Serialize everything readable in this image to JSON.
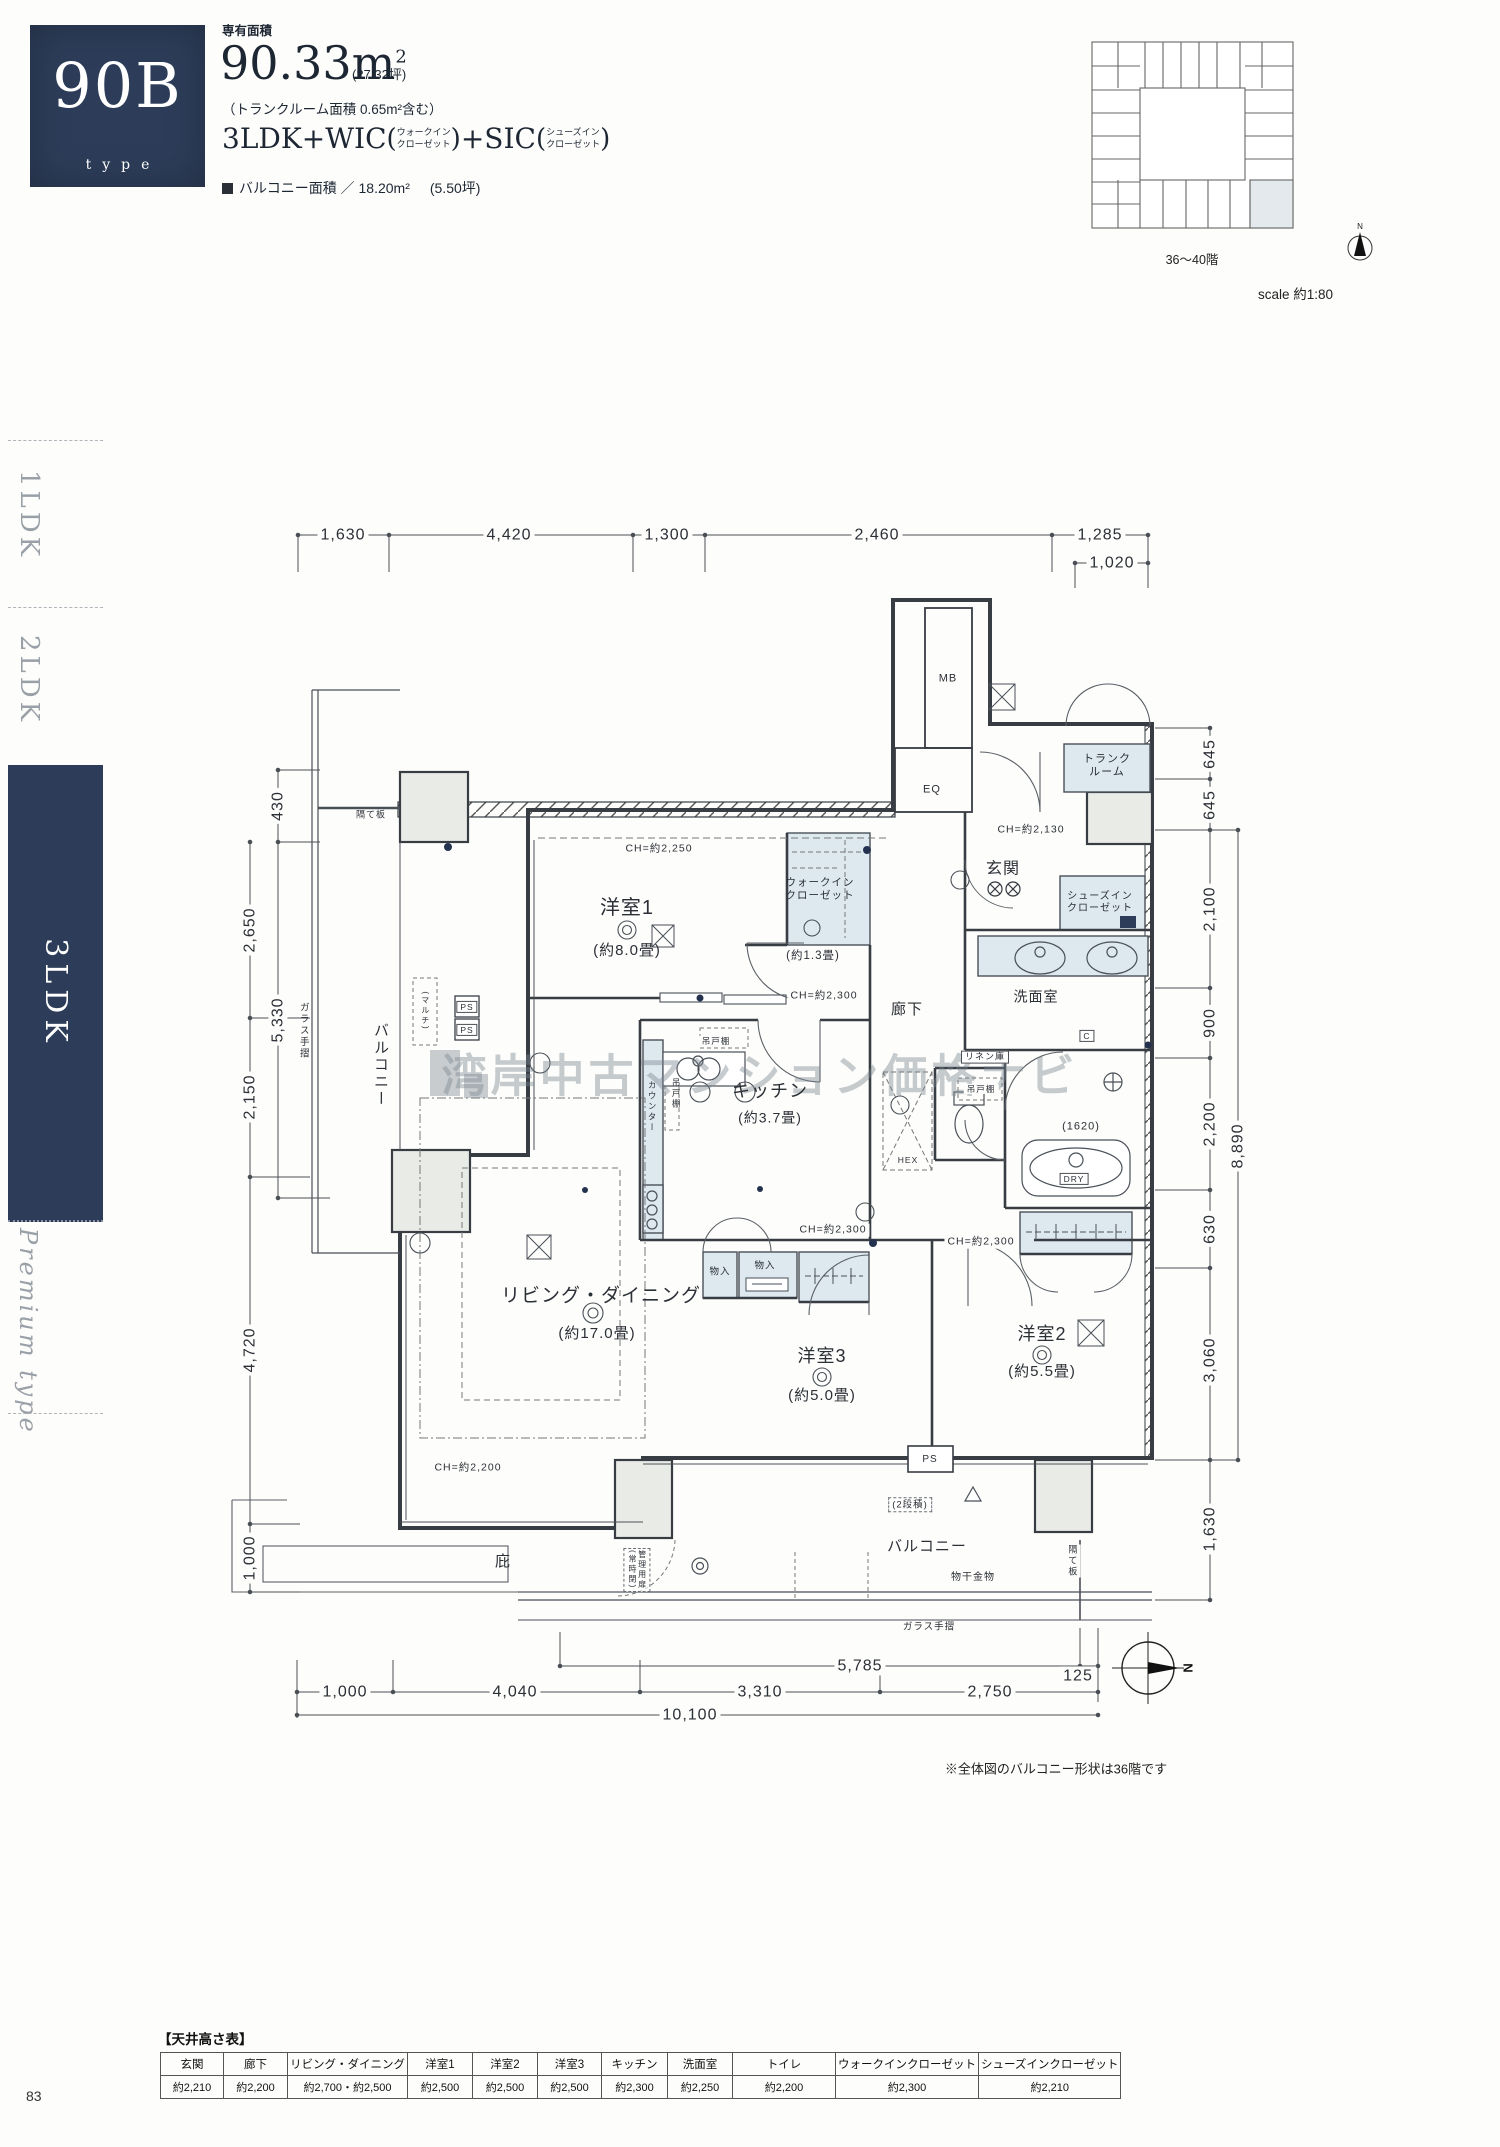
{
  "page": {
    "number": "83"
  },
  "sidebar": {
    "items": [
      {
        "label": "1LDK",
        "active": false
      },
      {
        "label": "2LDK",
        "active": false
      },
      {
        "label": "3LDK",
        "active": true
      },
      {
        "label": "Premium type",
        "active": false
      }
    ]
  },
  "header": {
    "type_code": "90B",
    "type_word": "type",
    "area_label": "専有面積",
    "area_value": "90.33m",
    "area_sup": "2",
    "area_tsubo": "(27.32坪)",
    "trunk_note": "（トランクルーム面積 0.65m²含む）",
    "layout_a": "3LDK+WIC",
    "wic_note_1": "ウォークイン",
    "wic_note_2": "クローゼット",
    "layout_b": "+SIC",
    "sic_note_1": "シューズイン",
    "sic_note_2": "クローゼット",
    "paren_open": "(",
    "paren_close": ")",
    "balcony_label": "バルコニー面積 ／ 18.20m²",
    "balcony_tsubo": "(5.50坪)"
  },
  "keyplan": {
    "floors": "36〜40階",
    "scale": "scale 約1:80",
    "north": "N"
  },
  "watermark": "湾岸中古マンション価格ナビ",
  "plan": {
    "note": "※全体図のバルコニー形状は36階です",
    "north": "N",
    "labels": [
      {
        "t": "洋室1",
        "x": 627,
        "y": 908,
        "s": 20
      },
      {
        "t": "(約8.0畳)",
        "x": 627,
        "y": 951,
        "s": 15
      },
      {
        "t": "リビング・ダイニング",
        "x": 601,
        "y": 1297,
        "s": 19
      },
      {
        "t": "(約17.0畳)",
        "x": 597,
        "y": 1334,
        "s": 15
      },
      {
        "t": "キッチン",
        "x": 770,
        "y": 1092,
        "s": 18
      },
      {
        "t": "(約3.7畳)",
        "x": 770,
        "y": 1118,
        "s": 14
      },
      {
        "t": "洋室3",
        "x": 822,
        "y": 1357,
        "s": 18
      },
      {
        "t": "(約5.0畳)",
        "x": 822,
        "y": 1396,
        "s": 15
      },
      {
        "t": "洋室2",
        "x": 1042,
        "y": 1335,
        "s": 18
      },
      {
        "t": "(約5.5畳)",
        "x": 1042,
        "y": 1372,
        "s": 15
      },
      {
        "t": "玄関",
        "x": 1003,
        "y": 869,
        "s": 16
      },
      {
        "t": "廊下",
        "x": 907,
        "y": 1010,
        "s": 15
      },
      {
        "t": "洗面室",
        "x": 1036,
        "y": 997,
        "s": 14,
        "w": 1
      },
      {
        "t": "バルコニー",
        "x": 380,
        "y": 1065,
        "s": 15,
        "v": 1
      },
      {
        "t": "バルコニー",
        "x": 927,
        "y": 1547,
        "s": 15
      },
      {
        "t": "庇",
        "x": 503,
        "y": 1562,
        "s": 15
      },
      {
        "t": "トランク\nルーム",
        "x": 1107,
        "y": 766,
        "s": 11
      },
      {
        "t": "ウォークイン\nクローゼット",
        "x": 820,
        "y": 889,
        "s": 10.5
      },
      {
        "t": "(約1.3畳)",
        "x": 813,
        "y": 957,
        "s": 11.5
      },
      {
        "t": "シューズイン\nクローゼット",
        "x": 1100,
        "y": 903,
        "s": 10
      },
      {
        "t": "CH=約2,250",
        "x": 659,
        "y": 849,
        "s": 10.5,
        "w": 1
      },
      {
        "t": "CH=約2,130",
        "x": 1031,
        "y": 830,
        "s": 10.5,
        "w": 1
      },
      {
        "t": "CH=約2,300",
        "x": 824,
        "y": 996,
        "s": 10.5,
        "w": 1
      },
      {
        "t": "CH=約2,300",
        "x": 833,
        "y": 1230,
        "s": 10.5,
        "w": 1
      },
      {
        "t": "CH=約2,300",
        "x": 981,
        "y": 1242,
        "s": 10.5,
        "w": 1
      },
      {
        "t": "CH=約2,200",
        "x": 468,
        "y": 1468,
        "s": 10.5,
        "w": 1
      },
      {
        "t": "MB",
        "x": 948,
        "y": 679,
        "s": 11
      },
      {
        "t": "EQ",
        "x": 932,
        "y": 790,
        "s": 11
      },
      {
        "t": "PS",
        "x": 467,
        "y": 1007,
        "s": 8.5,
        "b": "s"
      },
      {
        "t": "PS",
        "x": 467,
        "y": 1030,
        "s": 8.5,
        "b": "s"
      },
      {
        "t": "PS",
        "x": 930,
        "y": 1460,
        "s": 10
      },
      {
        "t": "C",
        "x": 1087,
        "y": 1036,
        "s": 8.5,
        "b": "s"
      },
      {
        "t": "DRY",
        "x": 1074,
        "y": 1179,
        "s": 8.5,
        "b": "s"
      },
      {
        "t": "(1620)",
        "x": 1081,
        "y": 1127,
        "s": 11
      },
      {
        "t": "リネン庫",
        "x": 985,
        "y": 1057,
        "s": 9,
        "b": "s"
      },
      {
        "t": "吊戸棚",
        "x": 716,
        "y": 1041,
        "s": 8.5,
        "w": 1
      },
      {
        "t": "吊戸棚",
        "x": 676,
        "y": 1094,
        "s": 8.5,
        "v": 1
      },
      {
        "t": "吊戸棚",
        "x": 981,
        "y": 1089,
        "s": 8.5,
        "w": 1
      },
      {
        "t": "カウンター",
        "x": 652,
        "y": 1107,
        "s": 8.5,
        "v": 1
      },
      {
        "t": "(マルチ)",
        "x": 425,
        "y": 1011,
        "s": 8,
        "v": 1
      },
      {
        "t": "HEX",
        "x": 908,
        "y": 1160,
        "s": 8.5
      },
      {
        "t": "物入",
        "x": 720,
        "y": 1272,
        "s": 9.5
      },
      {
        "t": "物入",
        "x": 765,
        "y": 1266,
        "s": 9.5
      },
      {
        "t": "(2段積)",
        "x": 910,
        "y": 1505,
        "s": 9.5,
        "b": "d"
      },
      {
        "t": "物干金物",
        "x": 973,
        "y": 1578,
        "s": 10,
        "w": 1
      },
      {
        "t": "ガラス手摺",
        "x": 303,
        "y": 1031,
        "s": 9.5,
        "v": 1
      },
      {
        "t": "ガラス手摺",
        "x": 929,
        "y": 1627,
        "s": 9.5,
        "w": 1
      },
      {
        "t": "隔て板",
        "x": 371,
        "y": 815,
        "s": 9,
        "w": 1
      },
      {
        "t": "隔て板",
        "x": 1072,
        "y": 1561,
        "s": 9,
        "v": 1,
        "w": 1
      },
      {
        "t": "管理用扉\n(常時閉)",
        "x": 637,
        "y": 1570,
        "s": 8,
        "v": 1,
        "b": "d"
      }
    ]
  },
  "dims": {
    "top": [
      {
        "t": "1,630",
        "x": 343,
        "y": 535,
        "w": 1
      },
      {
        "t": "4,420",
        "x": 509,
        "y": 535,
        "w": 1
      },
      {
        "t": "1,300",
        "x": 667,
        "y": 535,
        "w": 1
      },
      {
        "t": "2,460",
        "x": 877,
        "y": 535,
        "w": 1
      },
      {
        "t": "1,285",
        "x": 1100,
        "y": 535,
        "w": 1
      },
      {
        "t": "1,020",
        "x": 1112,
        "y": 563,
        "w": 1
      }
    ],
    "left": [
      {
        "t": "430",
        "x": 278,
        "y": 806,
        "r": 1,
        "w": 1
      },
      {
        "t": "2,650",
        "x": 250,
        "y": 930,
        "r": 1,
        "w": 1
      },
      {
        "t": "5,330",
        "x": 278,
        "y": 1020,
        "r": 1,
        "w": 1
      },
      {
        "t": "2,150",
        "x": 250,
        "y": 1097,
        "r": 1,
        "w": 1
      },
      {
        "t": "4,720",
        "x": 250,
        "y": 1350,
        "r": 1,
        "w": 1
      },
      {
        "t": "1,000",
        "x": 250,
        "y": 1558,
        "r": 1,
        "w": 1
      }
    ],
    "right": [
      {
        "t": "645",
        "x": 1210,
        "y": 754,
        "r": 1,
        "w": 1
      },
      {
        "t": "645",
        "x": 1210,
        "y": 805,
        "r": 1,
        "w": 1
      },
      {
        "t": "2,100",
        "x": 1210,
        "y": 909,
        "r": 1,
        "w": 1
      },
      {
        "t": "900",
        "x": 1210,
        "y": 1023,
        "r": 1,
        "w": 1
      },
      {
        "t": "2,200",
        "x": 1210,
        "y": 1124,
        "r": 1,
        "w": 1
      },
      {
        "t": "8,890",
        "x": 1238,
        "y": 1146,
        "r": 1,
        "w": 1
      },
      {
        "t": "630",
        "x": 1210,
        "y": 1229,
        "r": 1,
        "w": 1
      },
      {
        "t": "3,060",
        "x": 1210,
        "y": 1360,
        "r": 1,
        "w": 1
      },
      {
        "t": "1,630",
        "x": 1210,
        "y": 1529,
        "r": 1,
        "w": 1
      }
    ],
    "bottom": [
      {
        "t": "5,785",
        "x": 860,
        "y": 1666,
        "w": 1
      },
      {
        "t": "125",
        "x": 1078,
        "y": 1676,
        "w": 1
      },
      {
        "t": "1,000",
        "x": 345,
        "y": 1692,
        "w": 1
      },
      {
        "t": "4,040",
        "x": 515,
        "y": 1692,
        "w": 1
      },
      {
        "t": "3,310",
        "x": 760,
        "y": 1692,
        "w": 1
      },
      {
        "t": "2,750",
        "x": 990,
        "y": 1692,
        "w": 1
      },
      {
        "t": "10,100",
        "x": 690,
        "y": 1715,
        "w": 1
      }
    ]
  },
  "ceiling_table": {
    "title": "【天井高さ表】",
    "columns": [
      "玄関",
      "廊下",
      "リビング・ダイニング",
      "洋室1",
      "洋室2",
      "洋室3",
      "キッチン",
      "洗面室",
      "トイレ",
      "ウォークインクローゼット",
      "シューズインクローゼット"
    ],
    "values": [
      "約2,210",
      "約2,200",
      "約2,700・約2,500",
      "約2,500",
      "約2,500",
      "約2,500",
      "約2,300",
      "約2,250",
      "約2,200",
      "約2,300",
      "約2,210"
    ]
  }
}
